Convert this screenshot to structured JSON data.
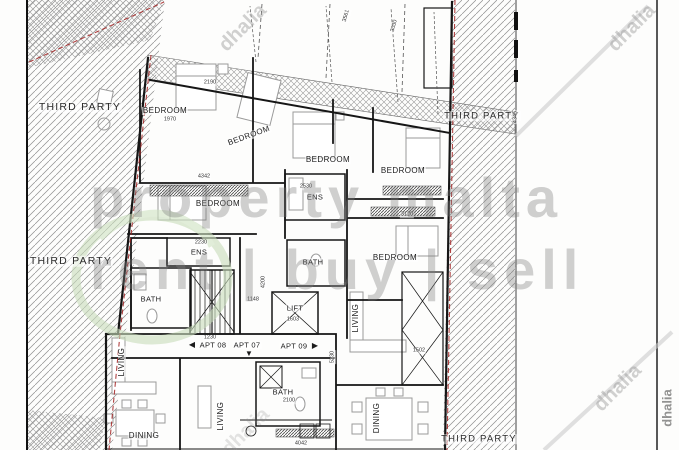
{
  "plan": {
    "third_party": "THIRD PARTY",
    "room_labels": {
      "bedroom": "BEDROOM",
      "ensuite": "ENS",
      "bath": "BATH",
      "lift": "LIFT",
      "living": "LIVING",
      "dining": "DINING"
    },
    "apartments": [
      {
        "label": "APT 08",
        "arrow": "◀"
      },
      {
        "label": "APT 07",
        "arrow": "▼"
      },
      {
        "label": "APT 09",
        "arrow": "▶"
      }
    ],
    "dimensions_mm": [
      "2190",
      "1970",
      "4342",
      "2530",
      "3120",
      "2230",
      "1148",
      "4200",
      "1603",
      "1230",
      "2100",
      "1502",
      "5230",
      "4345",
      "3561",
      "3030",
      "4042"
    ]
  },
  "watermarks": {
    "brand_line1": "property malta",
    "brand_line2": "rent | buy | sell",
    "agency": "dhalia"
  },
  "colors": {
    "wall_black": "#161616",
    "boundary_red": "#a32222",
    "logo_green": "#c8ddbb",
    "watermark_gray": "#7d7d7d"
  }
}
